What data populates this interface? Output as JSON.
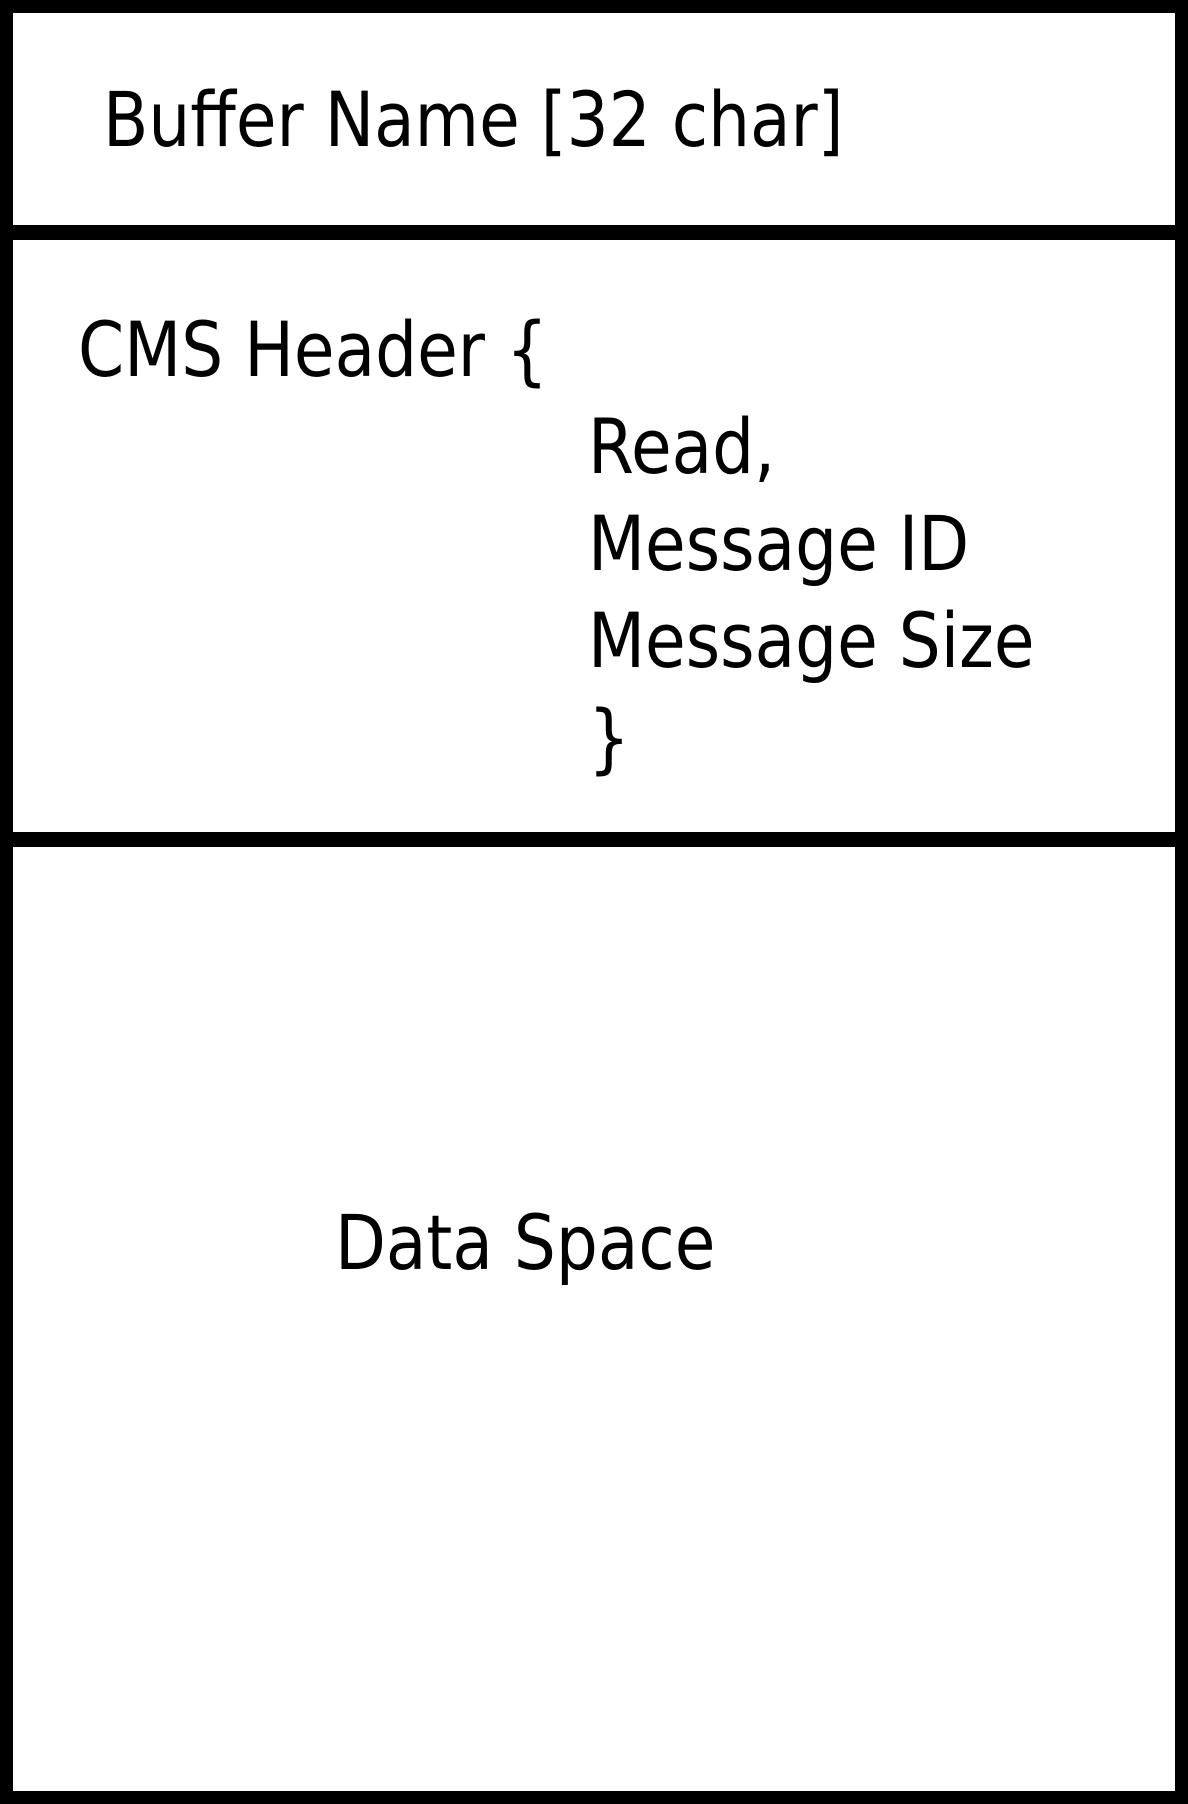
{
  "diagram": {
    "title": "shared memory buffer layout",
    "buffer_name_label": "Buffer Name [32 char]",
    "cms_header": {
      "open": "CMS Header {",
      "fields": [
        "Read,",
        "Message ID",
        "Message Size"
      ],
      "close": "}"
    },
    "data_space_label": "Data Space"
  },
  "colors": {
    "border": "#000000",
    "background": "#ffffff",
    "text": "#000000"
  }
}
